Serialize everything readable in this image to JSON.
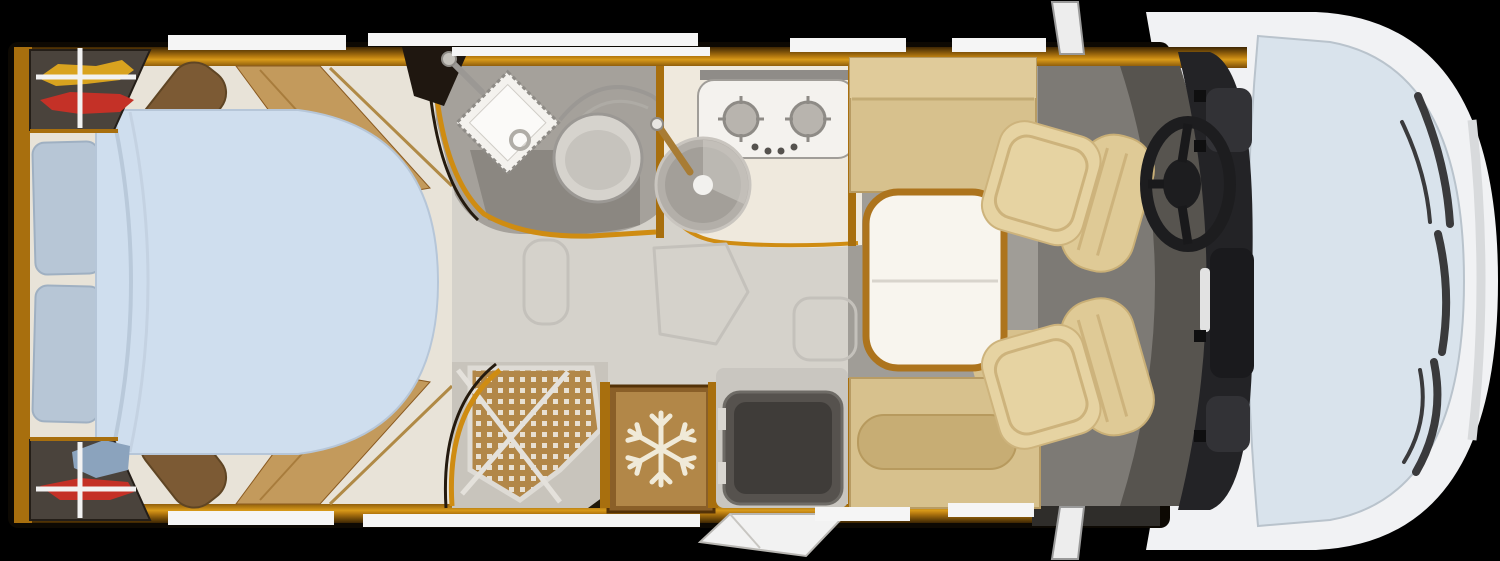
{
  "meta": {
    "diagram_type": "motorhome-floorplan-top-view",
    "orientation": "cab-front-on-right-rear-bedroom-on-left"
  },
  "palette": {
    "background": "#000000",
    "body_white": "#f1f2f4",
    "body_shade": "#d8dadc",
    "glass": "#d9e3ec",
    "wiper": "#3a3a3c",
    "wood": "#a86f0e",
    "gold": "#cf8c12",
    "trim_line": "#b08a46",
    "divider": "#a86f0e",
    "floor_cream": "#e8e3d8",
    "floor_gray": "#d5d2cb",
    "floor_saloon": "#a09d97",
    "cab_floor": "#7d7a75",
    "cab_floor_dark": "#57544f",
    "hatch_line": "#c4c1bb",
    "bed": "#cfdeee",
    "bed_fold": "#b9c9da",
    "pillow": "#b7c6d6",
    "wardrobe": "#4a433c",
    "clothes_yellow": "#d9a31f",
    "clothes_red": "#c43127",
    "clothes_blue": "#8ba3bd",
    "rail": "#f2f2f2",
    "slat_tan": "#c39a5c",
    "slat_brown": "#7c5a34",
    "bath_floor": "#a5a19b",
    "bath_floor_dark": "#8b8781",
    "basin": "#f4f2ee",
    "toilet_body": "#d6d3cd",
    "steel": "#9b9894",
    "counter": "#efe9dd",
    "hob": "#f4f2ee",
    "burner": "#b8b4ae",
    "sink": "#b3afa9",
    "brass": "#a87c34",
    "shower_tray": "#c8c4bc",
    "shower_mat": "#b28748",
    "mat_dot": "#e8e0d2",
    "fridge_outer": "#8a5f28",
    "fridge_panel": "#b28748",
    "snowflake": "#f0ead8",
    "step": "#56524e",
    "step_inner": "#3f3c39",
    "door": "#f2f2f2",
    "bench": "#d7c18d",
    "bench_light": "#e0cb9a",
    "bolster": "#c7ad74",
    "table": "#f8f5ee",
    "table_trim": "#ad741d",
    "seat_back": "#dfca96",
    "seat_cushion": "#e6d3a2",
    "seat_seam": "#cdb37c",
    "dash": "#232326",
    "dash_detail": "#323236",
    "wheel": "#1d1d1f",
    "window": "#f5f5f5",
    "mirror": "#ededed"
  },
  "areas": [
    {
      "id": "rear-bedroom",
      "name": "island-bed-bedroom"
    },
    {
      "id": "washroom",
      "name": "washroom-basin-toilet"
    },
    {
      "id": "shower",
      "name": "shower-cubicle"
    },
    {
      "id": "kitchen",
      "name": "kitchen-hob-sink"
    },
    {
      "id": "refrigerator",
      "name": "refrigerator"
    },
    {
      "id": "entrance",
      "name": "entrance-door-step"
    },
    {
      "id": "dinette",
      "name": "dinette-table-benches"
    },
    {
      "id": "cab",
      "name": "driver-cab-swivel-seats"
    }
  ],
  "furniture": [
    "island-bed",
    "pillow",
    "pillow",
    "wardrobe-top",
    "wardrobe-bottom",
    "washbasin",
    "toilet",
    "shower-tray",
    "two-burner-hob",
    "round-sink",
    "refrigerator",
    "entry-step",
    "entry-door",
    "dinette-bench-top",
    "dinette-bench-bottom",
    "dinette-table",
    "driver-seat",
    "passenger-seat",
    "dashboard",
    "steering-wheel"
  ],
  "icons": [
    {
      "name": "snowflake-icon",
      "meaning": "refrigerator"
    },
    {
      "name": "steering-wheel-icon",
      "meaning": "driver-position"
    },
    {
      "name": "clothes-icon",
      "meaning": "wardrobe-contents"
    },
    {
      "name": "burner-icon",
      "meaning": "gas-hob"
    },
    {
      "name": "faucet-icon",
      "meaning": "water-tap"
    }
  ],
  "counts": {
    "windows_top": 4,
    "windows_bottom": 4,
    "pillows": 2,
    "cab_seats": 2,
    "hob_burners": 2,
    "wardrobes": 2,
    "wiper_blades": 3,
    "side_mirrors": 2
  }
}
